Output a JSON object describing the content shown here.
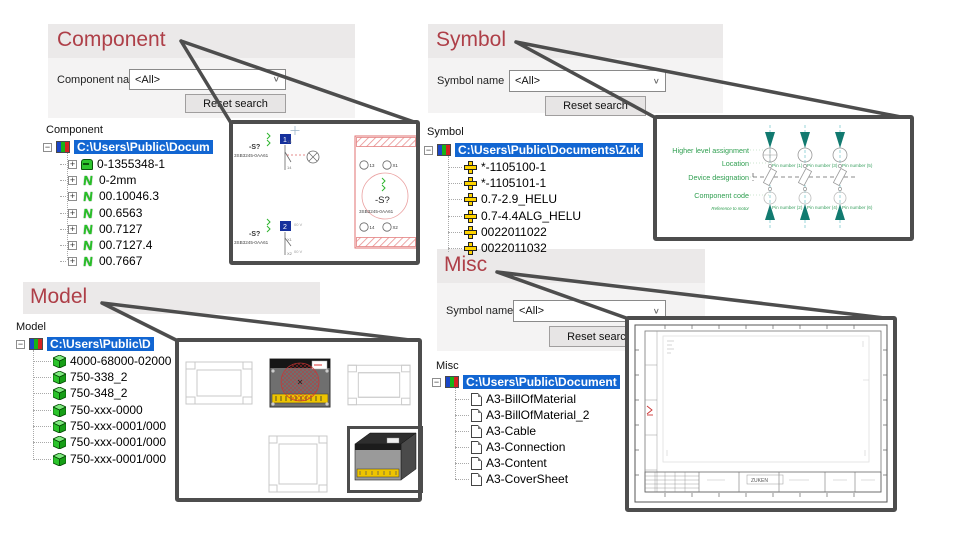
{
  "colors": {
    "title_red": "#ae3f48",
    "selection_blue": "#1266d2",
    "callout_gray": "#4d4d4d",
    "label_green": "#2e9e4f"
  },
  "panels": {
    "component": {
      "title": "Component",
      "name_label": "Component name",
      "filter_value": "<All>",
      "reset_label": "Reset search",
      "tree_label": "Component",
      "root": "C:\\Users\\Public\\Docum",
      "items": [
        {
          "label": "0-1355348-1"
        },
        {
          "label": "0-2mm"
        },
        {
          "label": "00.10046.3"
        },
        {
          "label": "00.6563"
        },
        {
          "label": "00.7127"
        },
        {
          "label": "00.7127.4"
        },
        {
          "label": "00.7667"
        }
      ]
    },
    "symbol": {
      "title": "Symbol",
      "name_label": "Symbol name",
      "filter_value": "<All>",
      "reset_label": "Reset search",
      "tree_label": "Symbol",
      "root": "C:\\Users\\Public\\Documents\\Zuk",
      "items": [
        {
          "label": "*-1105100-1"
        },
        {
          "label": "*-1105101-1"
        },
        {
          "label": "0.7-2.9_HELU"
        },
        {
          "label": "0.7-4.4ALG_HELU"
        },
        {
          "label": "0022011022"
        },
        {
          "label": "0022011032"
        }
      ]
    },
    "model": {
      "title": "Model",
      "tree_label": "Model",
      "root": "C:\\Users\\Public\\D",
      "items": [
        {
          "label": "4000-68000-02000"
        },
        {
          "label": "750-338_2"
        },
        {
          "label": "750-348_2"
        },
        {
          "label": "750-xxx-0000"
        },
        {
          "label": "750-xxx-0001/000"
        },
        {
          "label": "750-xxx-0001/000"
        },
        {
          "label": "750-xxx-0001/000"
        }
      ]
    },
    "misc": {
      "title": "Misc",
      "name_label": "Symbol name",
      "filter_value": "<All>",
      "reset_label": "Reset search",
      "tree_label": "Misc",
      "root": "C:\\Users\\Public\\Document",
      "items": [
        {
          "label": "A3-BillOfMaterial"
        },
        {
          "label": "A3-BillOfMaterial_2"
        },
        {
          "label": "A3-Cable"
        },
        {
          "label": "A3-Connection"
        },
        {
          "label": "A3-Content"
        },
        {
          "label": "A3-CoverSheet"
        }
      ]
    }
  },
  "callouts": {
    "component_preview": {
      "device_tag": "-S?",
      "part_number": "3SB3245-0AA61",
      "block1": "1",
      "block2": "2",
      "pin13": "13",
      "pin14": "14",
      "pinx1": "X1",
      "pinx2": "X2",
      "volt1": "00 V",
      "volt2": "00 V"
    },
    "symbol_preview": {
      "labels": [
        "Higher level assignment",
        "Location",
        "Device designation",
        "Component code",
        "Reference to motor"
      ],
      "pins_top": [
        "Pin number (1)",
        "Pin number (3)",
        "Pin number (5)"
      ],
      "pins_bottom": [
        "Pin number (2)",
        "Pin number (4)",
        "Pin number (6)"
      ]
    },
    "misc_preview": {
      "titleblock_text": "ZUKEN"
    }
  }
}
